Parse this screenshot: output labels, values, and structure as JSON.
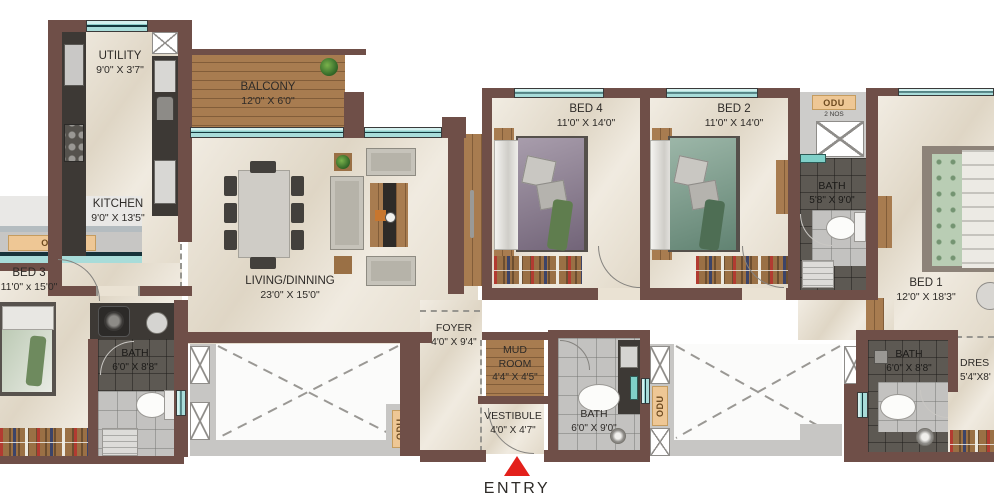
{
  "rooms": {
    "utility": {
      "name": "UTILITY",
      "dims": "9'0\" X 3'7\""
    },
    "balcony": {
      "name": "BALCONY",
      "dims": "12'0\" X 6'0\""
    },
    "kitchen": {
      "name": "KITCHEN",
      "dims": "9'0\" X 13'5\""
    },
    "living": {
      "name": "LIVING/DINNING",
      "dims": "23'0\" X 15'0\""
    },
    "bed4": {
      "name": "BED 4",
      "dims": "11'0\" X 14'0\""
    },
    "bed2": {
      "name": "BED 2",
      "dims": "11'0\" X 14'0\""
    },
    "bed1": {
      "name": "BED 1",
      "dims": "12'0\" X 18'3\""
    },
    "bed3": {
      "name": "BED 3",
      "dims": "11'0\" x 15'0\""
    },
    "bath_master": {
      "name": "BATH",
      "dims": "5'8\" X 9'0\""
    },
    "bath_bed3": {
      "name": "BATH",
      "dims": "6'0\" X 8'8\""
    },
    "bath_common": {
      "name": "BATH",
      "dims": "6'0\" X 9'0\""
    },
    "bath_bed1": {
      "name": "BATH",
      "dims": "6'0\" X 8'8\""
    },
    "foyer": {
      "name": "FOYER",
      "dims": "4'0\" X 9'4\""
    },
    "mud_room": {
      "name": "MUD ROOM",
      "dims": "4'4\" X 4'5\""
    },
    "vestibule": {
      "name": "VESTIBULE",
      "dims": "4'0\" X 4'7\""
    },
    "dress": {
      "name": "DRES",
      "dims": "5'4\"X8'"
    }
  },
  "odu": {
    "label": "ODU",
    "top_right_sub": "2 NOS"
  },
  "entry": {
    "label": "ENTRY"
  },
  "colors": {
    "wall": "#6f4f48",
    "marble_floor": "#eae2d3",
    "wood": "#a87c50",
    "window_teal": "#a8dcd9",
    "counter_dark": "#3d3935",
    "odu_tan": "#eec795",
    "entry_red": "#e3201b"
  }
}
